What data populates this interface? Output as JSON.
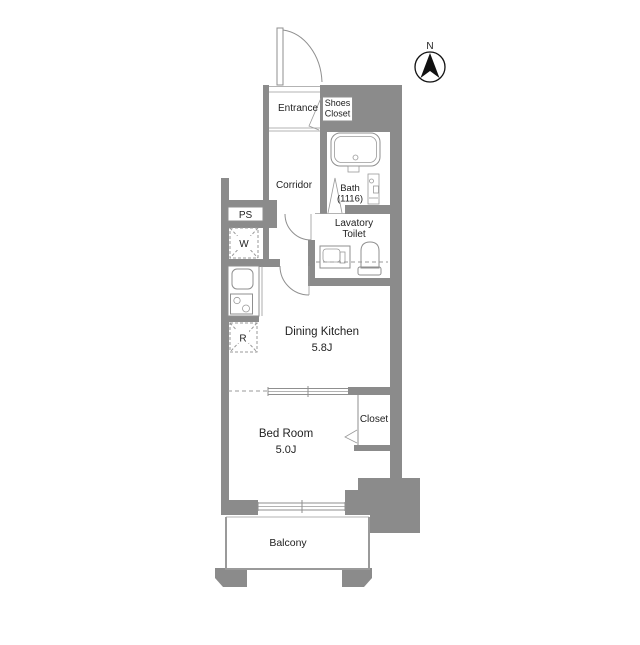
{
  "type": "apartment-floor-plan",
  "compass": {
    "north_label": "N"
  },
  "rooms": {
    "entrance": {
      "label": "Entrance"
    },
    "shoes_closet": {
      "label_line1": "Shoes",
      "label_line2": "Closet"
    },
    "corridor": {
      "label": "Corridor"
    },
    "bath": {
      "label_line1": "Bath",
      "label_line2": "(1116)"
    },
    "pipe_space": {
      "label": "PS"
    },
    "washer_space": {
      "label": "W"
    },
    "lavatory_toilet": {
      "label_line1": "Lavatory",
      "label_line2": "Toilet"
    },
    "refrigerator_space": {
      "label": "R"
    },
    "dining_kitchen": {
      "label": "Dining Kitchen",
      "area": "5.8J"
    },
    "closet": {
      "label": "Closet"
    },
    "bedroom": {
      "label": "Bed Room",
      "area": "5.0J"
    },
    "balcony": {
      "label": "Balcony"
    }
  },
  "colors": {
    "wall": "#8b8b8b",
    "fixture_line": "#8f8f8f",
    "text": "#222222",
    "background": "#ffffff"
  }
}
